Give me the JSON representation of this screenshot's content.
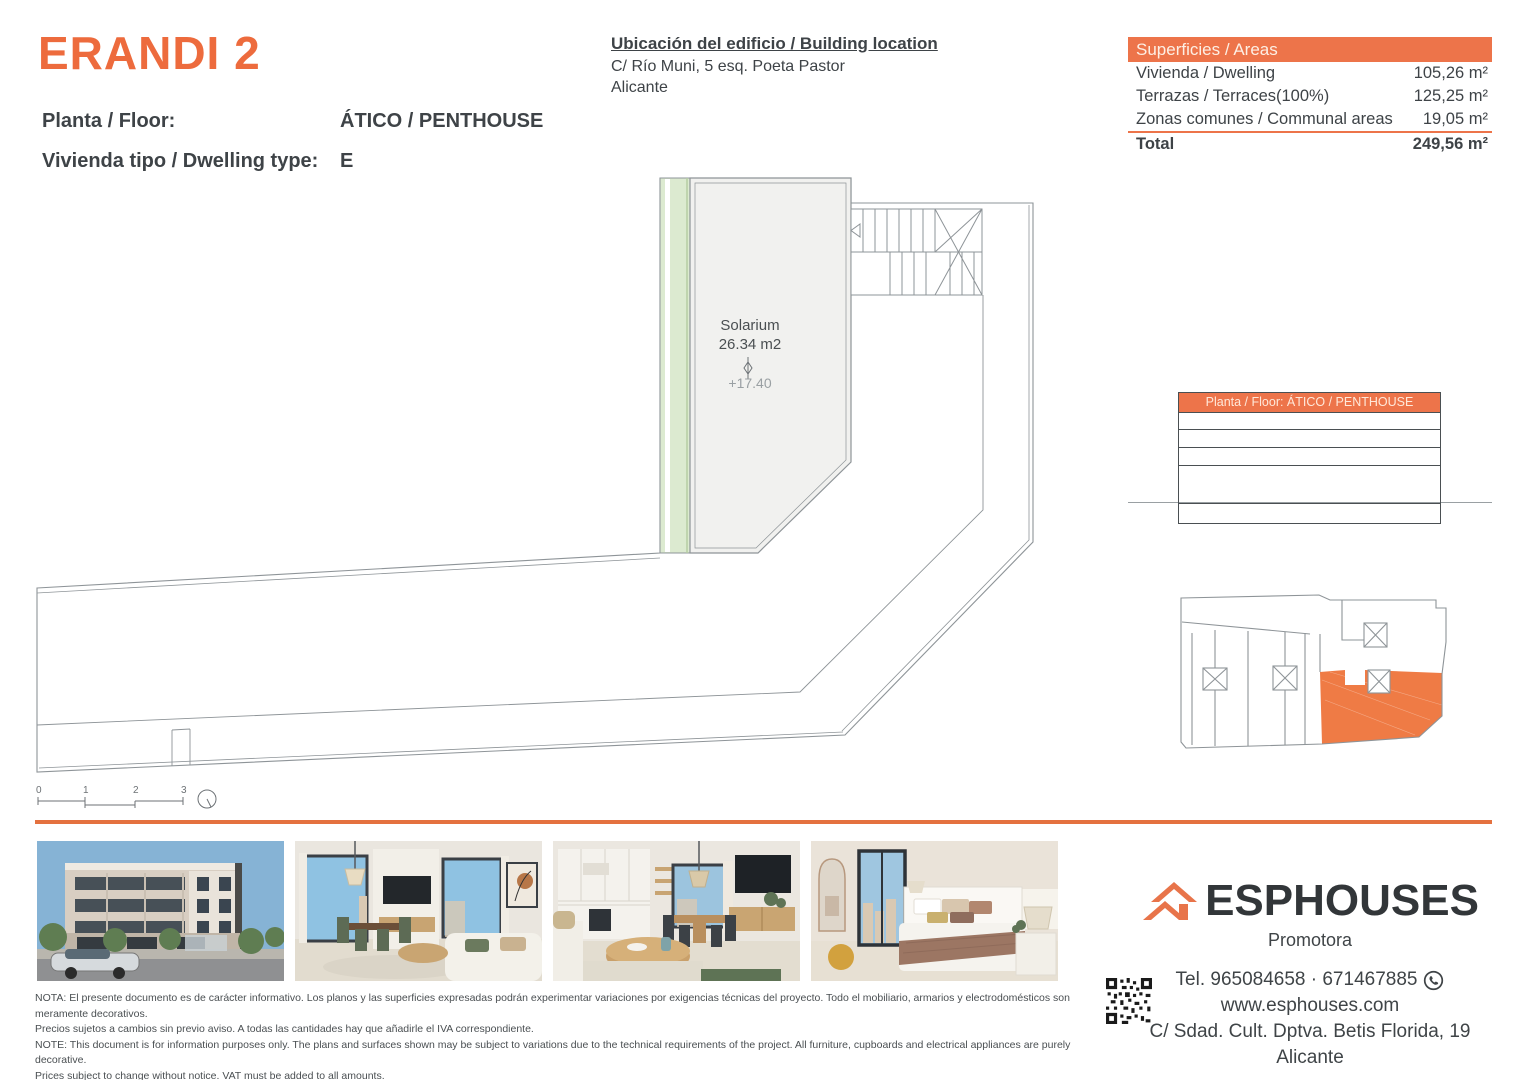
{
  "header": {
    "project_title": "ERANDI 2",
    "floor_label": "Planta / Floor:",
    "floor_value": "ÁTICO / PENTHOUSE",
    "dwelling_label": "Vivienda tipo / Dwelling type:",
    "dwelling_value": "E",
    "location_title": "Ubicación del edificio / Building location",
    "location_line1": "C/ Río Muni, 5 esq. Poeta Pastor",
    "location_line2": "Alicante"
  },
  "areas_table": {
    "header": "Superficies / Areas",
    "rows": [
      {
        "label": "Vivienda / Dwelling",
        "value": "105,26 m²"
      },
      {
        "label": "Terrazas / Terraces(100%)",
        "value": "125,25 m²"
      },
      {
        "label": "Zonas comunes / Communal areas",
        "value": "19,05 m²"
      }
    ],
    "total_label": "Total",
    "total_value": "249,56 m²"
  },
  "floor_plan": {
    "room_label": "Solarium",
    "room_area": "26.34 m2",
    "level": "+17.40",
    "scale_ticks": [
      "0",
      "1",
      "2",
      "3"
    ]
  },
  "mini_table": {
    "header": "Planta / Floor: ÁTICO / PENTHOUSE"
  },
  "photos": {
    "items": [
      {
        "name": "building-exterior"
      },
      {
        "name": "living-room"
      },
      {
        "name": "kitchen-dining"
      },
      {
        "name": "bedroom"
      }
    ]
  },
  "footer": {
    "brand": "ESPHOUSES",
    "brand_sub": "Promotora",
    "phone": "Tel. 965084658 · 671467885",
    "website": "www.esphouses.com",
    "address": "C/ Sdad. Cult. Dptva. Betis Florida, 19",
    "city": "Alicante",
    "notes": [
      "NOTA: El presente documento es de carácter informativo. Los planos y las superficies expresadas podrán experimentar variaciones por exigencias técnicas del proyecto. Todo el mobiliario, armarios y electrodomésticos son meramente decorativos.",
      "Precios sujetos a cambios sin previo aviso. A todas las cantidades hay que añadirle el IVA correspondiente.",
      "NOTE: This document is for information purposes only. The plans and surfaces shown may be subject to variations due to the technical requirements of the project. All furniture, cupboards and electrical appliances are purely decorative.",
      "Prices subject to change without notice. VAT must be added to all amounts."
    ]
  },
  "colors": {
    "accent": "#ED744A",
    "title": "#ED6B3D",
    "plan_line": "#8E9498",
    "site_highlight": "#EF7B45"
  }
}
